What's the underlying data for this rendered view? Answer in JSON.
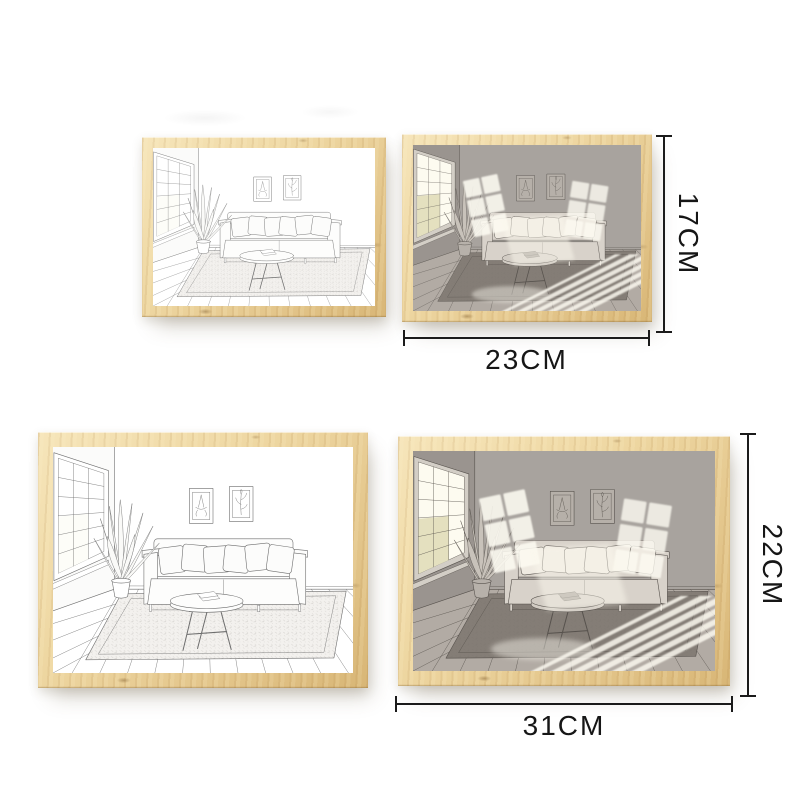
{
  "diagram": {
    "title": "wooden-frame-size-chart",
    "background": "#ffffff",
    "colors": {
      "wood": "#eed7a2",
      "shadow_art_wall": "#a8a39e",
      "dimension_lines": "#1b1b1b"
    },
    "small_frame": {
      "width_label": "23CM",
      "height_label": "17CM"
    },
    "large_frame": {
      "width_label": "31CM",
      "height_label": "22CM"
    },
    "frames": [
      {
        "size": "small",
        "art": "line-art"
      },
      {
        "size": "small",
        "art": "light-shadow-art"
      },
      {
        "size": "large",
        "art": "line-art"
      },
      {
        "size": "large",
        "art": "light-shadow-art"
      }
    ]
  }
}
